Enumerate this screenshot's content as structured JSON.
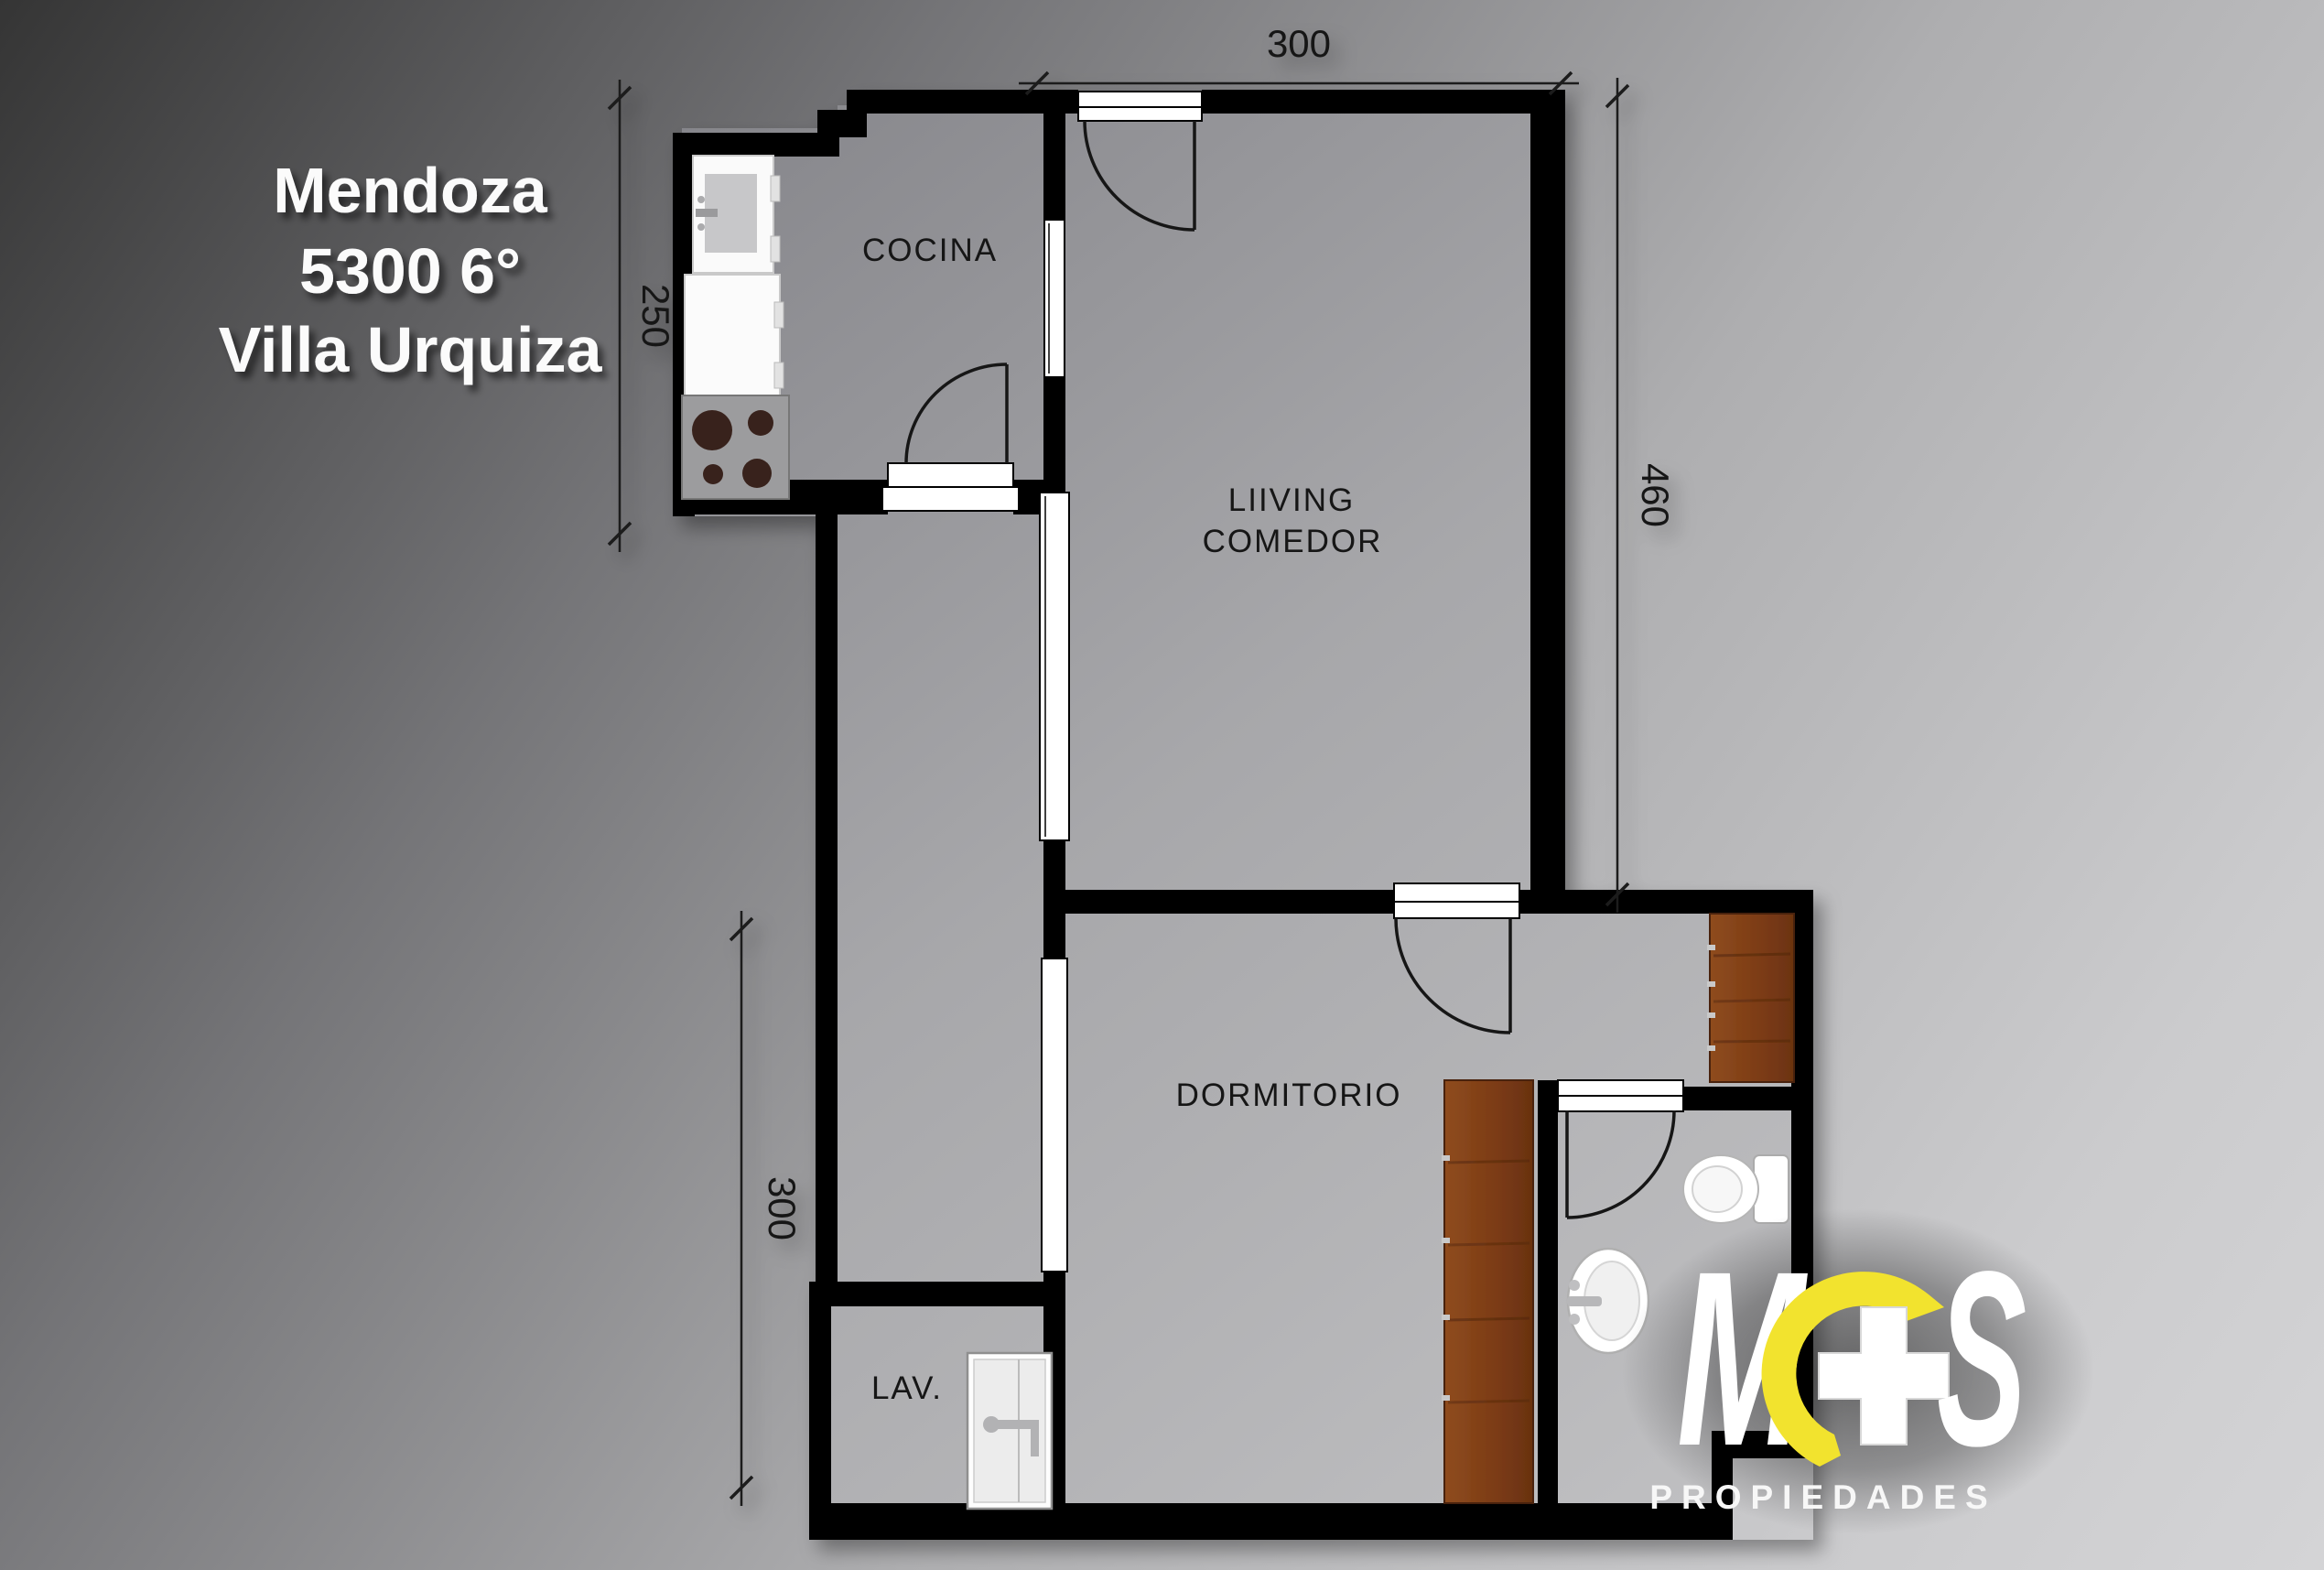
{
  "title": {
    "line1": "Mendoza",
    "line2": "5300 6°",
    "line3": "Villa Urquiza"
  },
  "floor_plan": {
    "rooms": {
      "kitchen": "COCINA",
      "living_line1": "LIIVING",
      "living_line2": "COMEDOR",
      "bedroom": "DORMITORIO",
      "laundry": "LAV."
    },
    "dimensions": {
      "top_width": "300",
      "right_height": "460",
      "left_kitchen_height": "250",
      "left_lower_height": "300"
    }
  },
  "logo": {
    "letter_m": "M",
    "letter_s": "S",
    "subtitle": "PROPIEDADES",
    "accent_color": "#f2e32e"
  },
  "colors": {
    "wall": "#000000",
    "floor_dark": "#85858a",
    "floor_light": "#c2c2c4",
    "background_dark": "#383838",
    "background_light": "#d2d2d4",
    "wood_dark": "#5e2d0e",
    "wood_light": "#8f4c1e"
  }
}
